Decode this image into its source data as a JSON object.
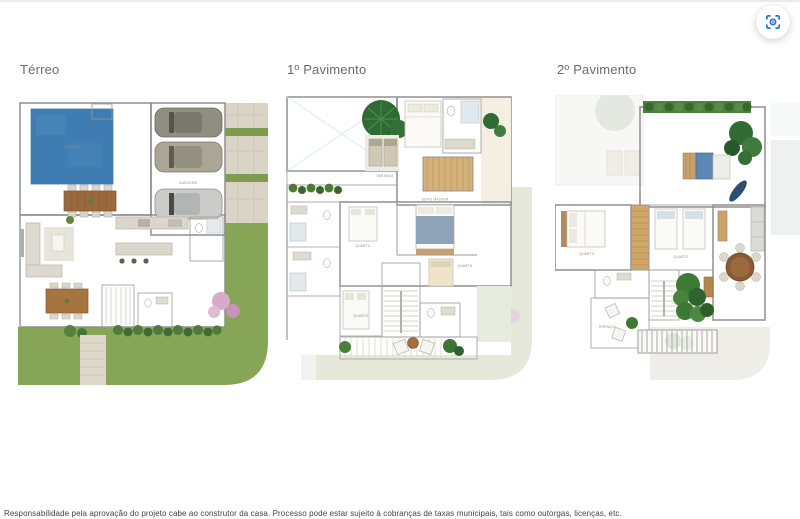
{
  "header": {
    "capture_button": {
      "icon": "screen-capture-icon",
      "accent_color": "#2b6fdb"
    }
  },
  "plans": [
    {
      "title": "Térreo",
      "labels": {
        "pool": "PISCINA",
        "garage": "GARAGEM"
      }
    },
    {
      "title": "1º Pavimento",
      "labels": {
        "balcony": "VARANDA",
        "master_suite": "SUÍTE MASTER",
        "bedroom_1": "QUARTO",
        "bedroom_2": "QUARTO",
        "bedroom_3": "QUARTO"
      }
    },
    {
      "title": "2º Pavimento",
      "labels": {
        "terrace": "TERRAÇO",
        "bedroom_1": "QUARTO",
        "bedroom_2": "QUARTO"
      }
    }
  ],
  "footer": {
    "disclaimer": "Responsabilidade pela aprovação do projeto cabe ao construtor da casa. Processo pode estar sujeito à cobranças de taxas municipais, tais como outorgas, licenças, etc."
  },
  "colors": {
    "pool_blue": "#3e7cb1",
    "lawn_green": "#86a557",
    "wood_floor": "#dbc193",
    "accent_blue": "#2b6fdb"
  }
}
